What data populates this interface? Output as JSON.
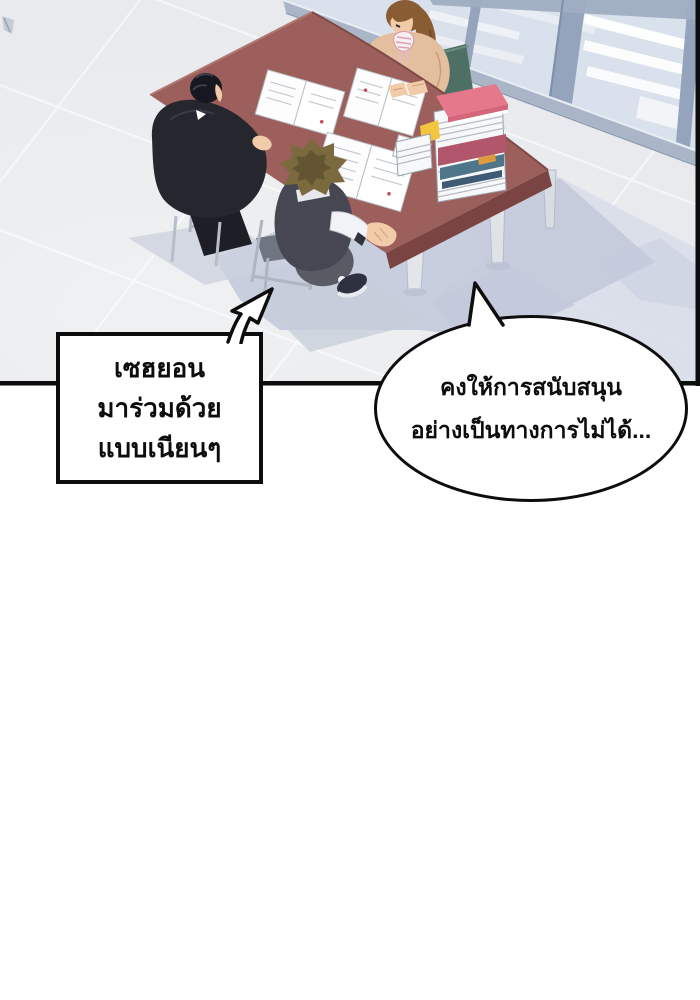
{
  "panel": {
    "narration_box": {
      "line1": "เซฮยอน",
      "line2": "มาร่วมด้วย",
      "line3": "แบบเนียนๆ"
    },
    "speech_bubble": {
      "line1": "คงให้การสนับสนุน",
      "line2": "อย่างเป็นทางการไม่ได้..."
    }
  },
  "colors": {
    "outline": "#0d0d0d",
    "floor": "#e7e9ec",
    "glass": "#d9e1ec",
    "wall_frame": "#93a4bc",
    "baseboard": "#aab6c8",
    "table_top": "#9c5f5b",
    "table_side": "#7a4442",
    "shadow": "#c3cada",
    "book_pink": "#e5798b",
    "book_yellow": "#f2c53e",
    "book_red": "#b2566b",
    "book_teal": "#4f758a",
    "chair_green": "#4e6f63",
    "sweater": "#e4bf9f",
    "skin": "#f2cba9",
    "hair_brown": "#8a5c33",
    "hair_black": "#17171f",
    "hair_spiky": "#7c6a3f",
    "suit": "#26262e",
    "vest": "#474754",
    "shirt_white": "#f2f3f6",
    "pants_gray": "#585a64",
    "metal_chair": "#aeb6c0",
    "paper": "#ffffff"
  }
}
